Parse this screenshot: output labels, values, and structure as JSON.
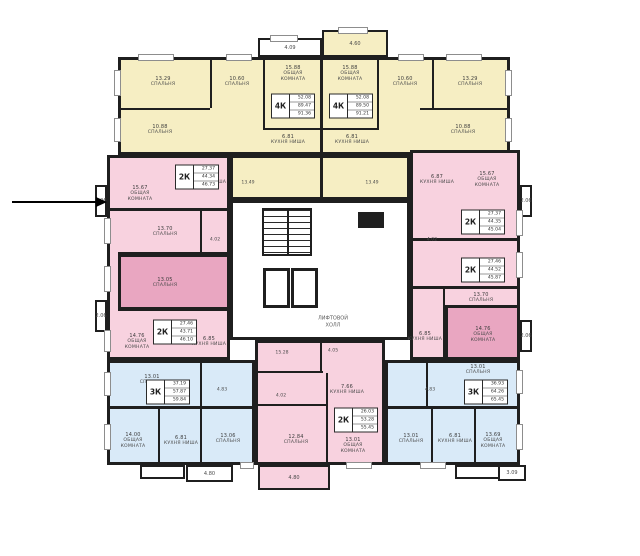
{
  "title": "Floor plan — residential storey",
  "palette": {
    "yellow": "#f6eec3",
    "pinkLight": "#f8d2df",
    "pinkDark": "#e9a6c1",
    "blue": "#d9eaf8",
    "white": "#ffffff",
    "wall": "#1f1f1f"
  },
  "arrow": {
    "x": 12,
    "y": 201,
    "length": 84
  },
  "core": {
    "label": "ЛИФТОВОЙ\nХОЛЛ",
    "label_x": 333,
    "label_y": 322,
    "stairs": {
      "x": 262,
      "y": 208,
      "w": 50,
      "h": 48
    },
    "lifts": [
      {
        "x": 263,
        "y": 268,
        "w": 27,
        "h": 40
      },
      {
        "x": 291,
        "y": 268,
        "w": 27,
        "h": 40
      }
    ],
    "shaft": {
      "x": 358,
      "y": 212,
      "w": 26,
      "h": 16
    }
  },
  "regions": [
    {
      "name": "core-area",
      "fill": "white",
      "x": 230,
      "y": 200,
      "w": 180,
      "h": 140
    },
    {
      "name": "yellow-top",
      "fill": "yellow",
      "x": 118,
      "y": 57,
      "w": 392,
      "h": 98
    },
    {
      "name": "yellow-center",
      "fill": "yellow",
      "x": 230,
      "y": 155,
      "w": 180,
      "h": 45
    },
    {
      "name": "pink-left",
      "fill": "pinkLight",
      "x": 107,
      "y": 155,
      "w": 123,
      "h": 205
    },
    {
      "name": "pink-left-dark",
      "fill": "pinkDark",
      "x": 118,
      "y": 254,
      "w": 112,
      "h": 56
    },
    {
      "name": "pink-right",
      "fill": "pinkLight",
      "x": 410,
      "y": 150,
      "w": 110,
      "h": 210
    },
    {
      "name": "pink-right-dark",
      "fill": "pinkDark",
      "x": 445,
      "y": 305,
      "w": 75,
      "h": 55
    },
    {
      "name": "pink-bottom",
      "fill": "pinkLight",
      "x": 255,
      "y": 340,
      "w": 130,
      "h": 125
    },
    {
      "name": "blue-left",
      "fill": "blue",
      "x": 107,
      "y": 360,
      "w": 148,
      "h": 105
    },
    {
      "name": "blue-right",
      "fill": "blue",
      "x": 385,
      "y": 360,
      "w": 135,
      "h": 105
    }
  ],
  "balconies": [
    {
      "text": "4.09",
      "x": 258,
      "y": 38,
      "w": 64,
      "h": 19,
      "fill": "white"
    },
    {
      "text": "4.60",
      "x": 322,
      "y": 30,
      "w": 66,
      "h": 27,
      "fill": "yellow"
    },
    {
      "text": "1.96",
      "x": 95,
      "y": 185,
      "w": 12,
      "h": 32,
      "fill": "white"
    },
    {
      "text": "2.06",
      "x": 95,
      "y": 300,
      "w": 12,
      "h": 32,
      "fill": "white"
    },
    {
      "text": "2.06",
      "x": 520,
      "y": 185,
      "w": 12,
      "h": 32,
      "fill": "white"
    },
    {
      "text": "2.06",
      "x": 520,
      "y": 320,
      "w": 12,
      "h": 32,
      "fill": "white"
    },
    {
      "text": "",
      "x": 140,
      "y": 465,
      "w": 45,
      "h": 14,
      "fill": "white"
    },
    {
      "text": "4.80",
      "x": 186,
      "y": 465,
      "w": 47,
      "h": 17,
      "fill": "white"
    },
    {
      "text": "4.80",
      "x": 258,
      "y": 465,
      "w": 72,
      "h": 25,
      "fill": "pinkLight"
    },
    {
      "text": "",
      "x": 455,
      "y": 465,
      "w": 45,
      "h": 14,
      "fill": "white"
    },
    {
      "text": "3.09",
      "x": 498,
      "y": 465,
      "w": 28,
      "h": 16,
      "fill": "white"
    }
  ],
  "walls": [
    [
      210,
      57,
      2,
      51
    ],
    [
      263,
      57,
      2,
      73
    ],
    [
      320,
      57,
      3,
      143
    ],
    [
      377,
      57,
      2,
      73
    ],
    [
      432,
      57,
      2,
      51
    ],
    [
      118,
      108,
      92,
      2
    ],
    [
      420,
      108,
      90,
      2
    ],
    [
      263,
      128,
      116,
      2
    ],
    [
      230,
      153,
      180,
      3
    ],
    [
      230,
      198,
      180,
      3
    ],
    [
      107,
      208,
      123,
      3
    ],
    [
      118,
      252,
      112,
      3
    ],
    [
      118,
      308,
      112,
      3
    ],
    [
      200,
      210,
      2,
      42
    ],
    [
      410,
      238,
      110,
      3
    ],
    [
      410,
      286,
      110,
      3
    ],
    [
      443,
      286,
      2,
      74
    ],
    [
      320,
      340,
      2,
      33
    ],
    [
      255,
      371,
      68,
      2
    ],
    [
      326,
      373,
      2,
      92
    ],
    [
      256,
      404,
      72,
      2
    ],
    [
      200,
      360,
      2,
      48
    ],
    [
      107,
      406,
      148,
      3
    ],
    [
      158,
      408,
      2,
      57
    ],
    [
      200,
      408,
      2,
      57
    ],
    [
      426,
      360,
      2,
      48
    ],
    [
      385,
      406,
      135,
      3
    ],
    [
      431,
      408,
      2,
      57
    ],
    [
      474,
      408,
      2,
      57
    ]
  ],
  "windows": [
    [
      138,
      54,
      36,
      7
    ],
    [
      226,
      54,
      26,
      7
    ],
    [
      398,
      54,
      26,
      7
    ],
    [
      446,
      54,
      36,
      7
    ],
    [
      270,
      35,
      28,
      7
    ],
    [
      338,
      27,
      30,
      7
    ],
    [
      114,
      70,
      7,
      26
    ],
    [
      114,
      118,
      7,
      24
    ],
    [
      505,
      70,
      7,
      26
    ],
    [
      505,
      118,
      7,
      24
    ],
    [
      104,
      218,
      7,
      26
    ],
    [
      104,
      266,
      7,
      26
    ],
    [
      104,
      330,
      7,
      22
    ],
    [
      104,
      372,
      7,
      24
    ],
    [
      104,
      424,
      7,
      26
    ],
    [
      516,
      210,
      7,
      26
    ],
    [
      516,
      252,
      7,
      26
    ],
    [
      516,
      370,
      7,
      24
    ],
    [
      516,
      424,
      7,
      26
    ],
    [
      240,
      462,
      14,
      7
    ],
    [
      346,
      462,
      26,
      7
    ],
    [
      420,
      462,
      26,
      7
    ]
  ],
  "rooms": [
    {
      "area": "13.29",
      "name": "СПАЛЬНЯ",
      "x": 163,
      "y": 82
    },
    {
      "area": "10.60",
      "name": "СПАЛЬНЯ",
      "x": 237,
      "y": 82
    },
    {
      "area": "15.88",
      "name": "ОБЩАЯ КОМНАТА",
      "x": 293,
      "y": 74
    },
    {
      "area": "15.88",
      "name": "ОБЩАЯ КОМНАТА",
      "x": 350,
      "y": 74
    },
    {
      "area": "10.60",
      "name": "СПАЛЬНЯ",
      "x": 405,
      "y": 82
    },
    {
      "area": "13.29",
      "name": "СПАЛЬНЯ",
      "x": 470,
      "y": 82
    },
    {
      "area": "10.88",
      "name": "СПАЛЬНЯ",
      "x": 160,
      "y": 130
    },
    {
      "area": "10.88",
      "name": "СПАЛЬНЯ",
      "x": 463,
      "y": 130
    },
    {
      "area": "6.81",
      "name": "КУХНЯ НИША",
      "x": 288,
      "y": 140
    },
    {
      "area": "6.81",
      "name": "КУХНЯ НИША",
      "x": 352,
      "y": 140
    },
    {
      "area": "15.67",
      "name": "ОБЩАЯ КОМНАТА",
      "x": 140,
      "y": 194
    },
    {
      "area": "6.81",
      "name": "КУХНЯ НИША",
      "x": 209,
      "y": 180
    },
    {
      "area": "13.70",
      "name": "СПАЛЬНЯ",
      "x": 165,
      "y": 232
    },
    {
      "area": "13.05",
      "name": "СПАЛЬНЯ",
      "x": 165,
      "y": 283
    },
    {
      "area": "14.76",
      "name": "ОБЩАЯ КОМНАТА",
      "x": 137,
      "y": 342
    },
    {
      "area": "6.85",
      "name": "КУХНЯ НИША",
      "x": 209,
      "y": 342
    },
    {
      "area": "6.87",
      "name": "КУХНЯ НИША",
      "x": 437,
      "y": 180
    },
    {
      "area": "15.67",
      "name": "ОБЩАЯ КОМНАТА",
      "x": 487,
      "y": 180
    },
    {
      "area": "13.70",
      "name": "СПАЛЬНЯ",
      "x": 481,
      "y": 298
    },
    {
      "area": "14.76",
      "name": "ОБЩАЯ КОМНАТА",
      "x": 483,
      "y": 335
    },
    {
      "area": "6.85",
      "name": "КУХНЯ НИША",
      "x": 425,
      "y": 337
    },
    {
      "area": "7.66",
      "name": "КУХНЯ НИША",
      "x": 347,
      "y": 390
    },
    {
      "area": "12.84",
      "name": "СПАЛЬНЯ",
      "x": 296,
      "y": 440
    },
    {
      "area": "13.01",
      "name": "ОБЩАЯ КОМНАТА",
      "x": 353,
      "y": 446
    },
    {
      "area": "13.01",
      "name": "СПАЛЬНЯ",
      "x": 152,
      "y": 380
    },
    {
      "area": "14.00",
      "name": "ОБЩАЯ КОМНАТА",
      "x": 133,
      "y": 441
    },
    {
      "area": "6.81",
      "name": "КУХНЯ НИША",
      "x": 181,
      "y": 441
    },
    {
      "area": "13.06",
      "name": "СПАЛЬНЯ",
      "x": 228,
      "y": 439
    },
    {
      "area": "13.01",
      "name": "СПАЛЬНЯ",
      "x": 478,
      "y": 370
    },
    {
      "area": "13.01",
      "name": "СПАЛЬНЯ",
      "x": 411,
      "y": 439
    },
    {
      "area": "6.81",
      "name": "КУХНЯ НИША",
      "x": 455,
      "y": 439
    },
    {
      "area": "13.69",
      "name": "ОБЩАЯ КОМНАТА",
      "x": 493,
      "y": 441
    }
  ],
  "units": [
    {
      "type": "4К",
      "values": [
        "52.08",
        "89.47",
        "91.36"
      ],
      "x": 293,
      "y": 106
    },
    {
      "type": "4К",
      "values": [
        "52.08",
        "89.50",
        "91.21"
      ],
      "x": 351,
      "y": 106
    },
    {
      "type": "2К",
      "values": [
        "27.37",
        "44.34",
        "46.73"
      ],
      "x": 197,
      "y": 177
    },
    {
      "type": "2К",
      "values": [
        "27.46",
        "43.71",
        "46.10"
      ],
      "x": 175,
      "y": 332
    },
    {
      "type": "2К",
      "values": [
        "27.37",
        "44.35",
        "45.04"
      ],
      "x": 483,
      "y": 222
    },
    {
      "type": "2К",
      "values": [
        "27.46",
        "44.52",
        "45.87"
      ],
      "x": 483,
      "y": 270
    },
    {
      "type": "2К",
      "values": [
        "26.03",
        "53.28",
        "55.45"
      ],
      "x": 356,
      "y": 420
    },
    {
      "type": "3К",
      "values": [
        "37.19",
        "57.87",
        "59.84"
      ],
      "x": 168,
      "y": 392
    },
    {
      "type": "3К",
      "values": [
        "36.93",
        "64.26",
        "65.45"
      ],
      "x": 486,
      "y": 392
    }
  ],
  "small_labels": [
    {
      "text": "13.49",
      "x": 248,
      "y": 183
    },
    {
      "text": "13.49",
      "x": 372,
      "y": 183
    },
    {
      "text": "4.02",
      "x": 215,
      "y": 240
    },
    {
      "text": "4.02",
      "x": 432,
      "y": 240
    },
    {
      "text": "15.28",
      "x": 282,
      "y": 353
    },
    {
      "text": "4.05",
      "x": 333,
      "y": 351
    },
    {
      "text": "4.02",
      "x": 281,
      "y": 396
    },
    {
      "text": "4.83",
      "x": 222,
      "y": 390
    },
    {
      "text": "4.83",
      "x": 430,
      "y": 390
    }
  ]
}
